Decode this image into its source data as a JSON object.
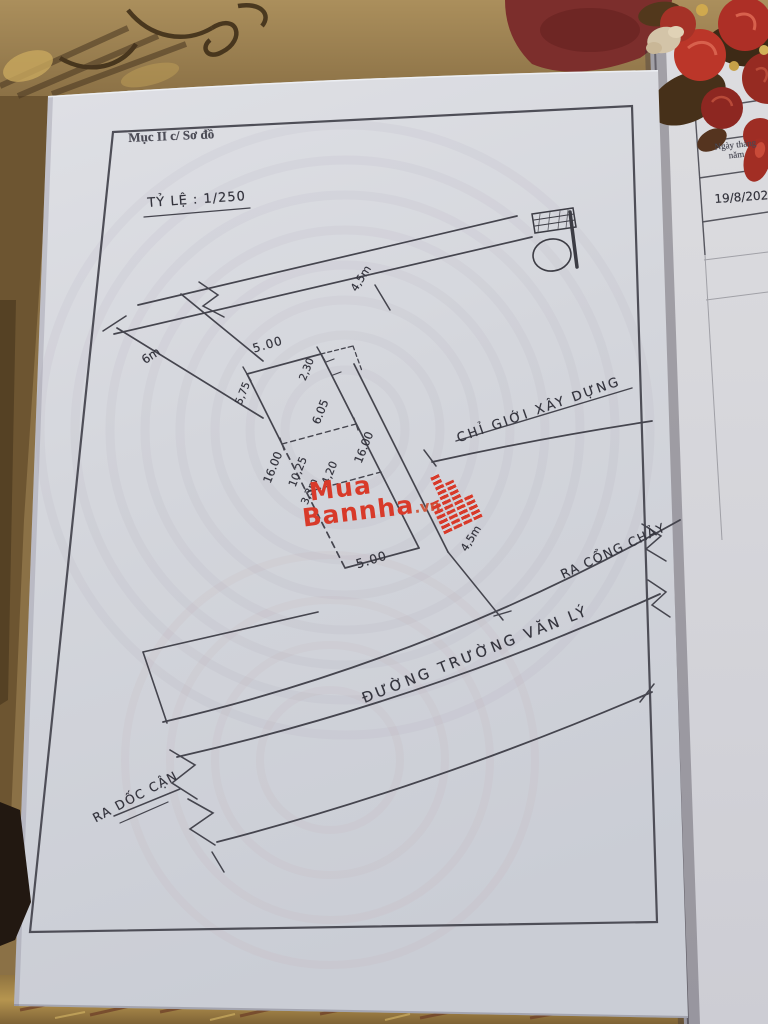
{
  "sheet": {
    "section_label": "Mục II c/ Sơ đồ",
    "scale_label": "TỶ LỆ : 1/250",
    "dims": {
      "road_width_left": "6m",
      "setback_top": "4,5m",
      "setback_right": "4,5m",
      "top": "5.00",
      "top_right_inset": "2,30",
      "left_upper": "5,75",
      "left_total": "16.00",
      "left_lower_inner": "10,25",
      "right_upper": "6.05",
      "right_total": "16.00",
      "right_mid": "4,20",
      "right_lower": "3,3m",
      "bottom": "5.00"
    },
    "labels": {
      "building_line": "CHỈ GIỚI XÂY DỰNG",
      "street": "ĐƯỜNG TRƯỜNG VĂN LÝ",
      "to_gate": "RA CỔNG CHẢY",
      "to_slope": "RA DỐC CẬN"
    }
  },
  "watermark": {
    "word1": "Mua",
    "word2": "Bannha",
    "tld": ".vn",
    "color": "#d83a2a"
  },
  "side_sheet": {
    "header_line1": "Ngày tháng",
    "header_line2": "năm",
    "date_entry": "19/8/202"
  },
  "colors": {
    "paper": "#d5d7dd",
    "ink": "#45454e",
    "carpet_gold": "#a0854f",
    "carpet_maroon": "#7c2e2c",
    "flower_red": "#b23228",
    "logo_red": "#d83a2a"
  }
}
